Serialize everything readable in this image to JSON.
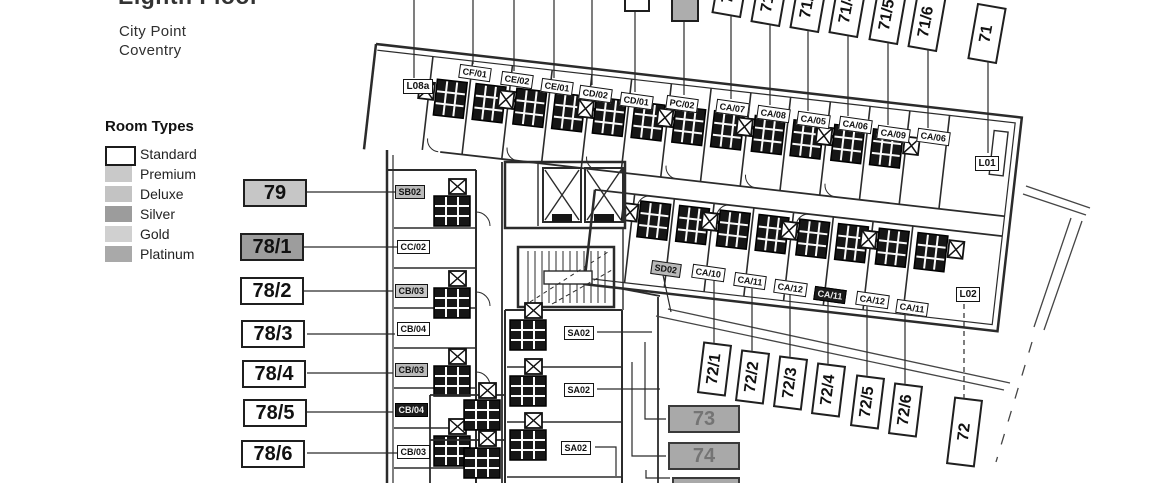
{
  "header": {
    "title": "Eighth Floor",
    "building": "City Point",
    "city": "Coventry"
  },
  "legend": {
    "title": "Room Types",
    "items": [
      {
        "label": "Standard",
        "color": "#ffffff"
      },
      {
        "label": "Premium",
        "color": "#c9c9c9"
      },
      {
        "label": "Deluxe",
        "color": "#c3c3c3"
      },
      {
        "label": "Silver",
        "color": "#9c9c9c"
      },
      {
        "label": "Gold",
        "color": "#d0d0d0"
      },
      {
        "label": "Platinum",
        "color": "#a9a9a9"
      }
    ]
  },
  "callouts": {
    "left": [
      {
        "label": "79",
        "fill": "#c6c6c6"
      },
      {
        "label": "78/1",
        "fill": "#9d9d9d"
      },
      {
        "label": "78/2",
        "fill": "#ffffff"
      },
      {
        "label": "78/3",
        "fill": "#ffffff"
      },
      {
        "label": "78/4",
        "fill": "#ffffff"
      },
      {
        "label": "78/5",
        "fill": "#ffffff"
      },
      {
        "label": "78/6",
        "fill": "#ffffff"
      }
    ],
    "top": [
      "71/1",
      "71/2",
      "71/3",
      "71/4",
      "71/5",
      "71/6",
      "71"
    ],
    "bottom": [
      "72/1",
      "72/2",
      "72/3",
      "72/4",
      "72/5",
      "72/6",
      "72"
    ],
    "side": [
      {
        "label": "73",
        "fill": "#a9a9a9"
      },
      {
        "label": "74",
        "fill": "#a9a9a9"
      },
      {
        "label": "75",
        "fill": "#a9a9a9"
      }
    ]
  },
  "plan_labels": {
    "l08a": "L08a",
    "cf01": "CF/01",
    "ce02": "CE/02",
    "ce01": "CE/01",
    "cd02": "CD/02",
    "cd01": "CD/01",
    "pc02": "PC/02",
    "ca07": "CA/07",
    "ca08": "CA/08",
    "ca05": "CA/05",
    "ca06": "CA/06",
    "ca09": "CA/09",
    "l01": "L01",
    "sd02": "SD02",
    "ca10": "CA/10",
    "ca11": "CA/11",
    "ca12": "CA/12",
    "l02": "L02",
    "sb02": "SB02",
    "cc02": "CC/02",
    "cb03": "CB/03",
    "cb04": "CB/04",
    "sa02": "SA02"
  }
}
